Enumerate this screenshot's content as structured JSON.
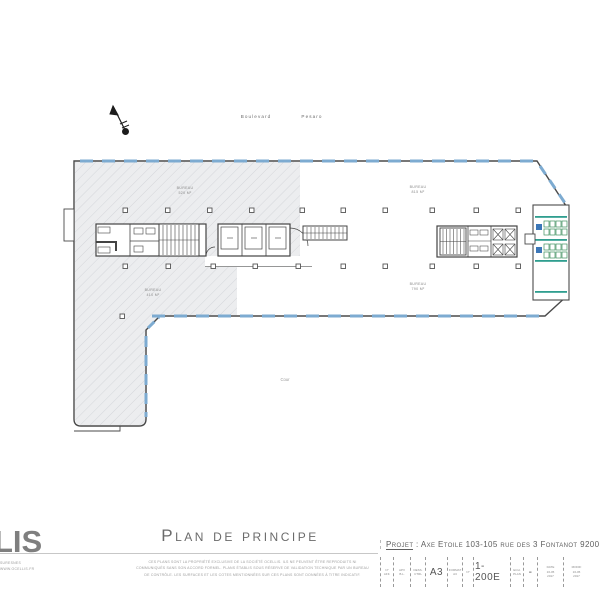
{
  "colors": {
    "window-blue": "#7dabd1",
    "furn-green": "#3f9060",
    "teal": "#2f9e8f",
    "accent-blue": "#3c77b8",
    "hatch-fill": "#ecedef",
    "hatch-line": "#d4d6da",
    "wall": "#4a4a4a"
  },
  "site": {
    "street_1": "Boulevard",
    "street_2": "Pesaro",
    "courtyard": "Cour"
  },
  "plan": {
    "area_labels": [
      {
        "line1": "Bureau",
        "line2": "520 m²"
      },
      {
        "line1": "Bureau",
        "line2": "410 m²"
      },
      {
        "line1": "Bureau",
        "line2": "815 m²"
      },
      {
        "line1": "Bureau",
        "line2": "790 m²"
      }
    ]
  },
  "titleblock": {
    "logo": "LIS",
    "logo_sub": [
      "Suresnes",
      "www.ocellis.fr"
    ],
    "title": "Plan de principe",
    "disclaimer": [
      "Ces plans sont la propriété exclusive de la société Ocellis. Ils ne peuvent être reproduits ni",
      "communiqués sans son accord formel. Plans établis sous réserve de validation technique par un bureau",
      "de contrôle. Les surfaces et les cotes mentionnées sur ces plans sont données à titre indicatif."
    ],
    "project_label": "Projet",
    "project_sep": " : ",
    "project_value": "Axe Etoile 103-105 rue des 3 Fontanot 9200",
    "fields": [
      {
        "w": 13,
        "lines": [
          "N°",
          "Aff."
        ],
        "big": ""
      },
      {
        "w": 17,
        "lines": [
          "APV",
          "B.L."
        ],
        "big": ""
      },
      {
        "w": 15,
        "lines": [
          "Dess.",
          "Ctrl"
        ],
        "big": ""
      },
      {
        "w": 22,
        "lines": [],
        "big": "A3"
      },
      {
        "w": 15,
        "lines": [
          "Format",
          "A3"
        ],
        "big": ""
      },
      {
        "w": 11,
        "lines": [
          "N°"
        ],
        "big": ""
      },
      {
        "w": 37,
        "lines": [],
        "big": "1-200E"
      },
      {
        "w": 13,
        "lines": [
          "Ech.",
          "Plan"
        ],
        "big": ""
      },
      {
        "w": 14,
        "lines": [],
        "big": "-"
      },
      {
        "w": 26,
        "lines": [
          "Date",
          "16-05",
          "2017"
        ],
        "big": ""
      },
      {
        "w": 26,
        "lines": [
          "Modif",
          "16-05",
          "2017"
        ],
        "big": ""
      }
    ]
  }
}
